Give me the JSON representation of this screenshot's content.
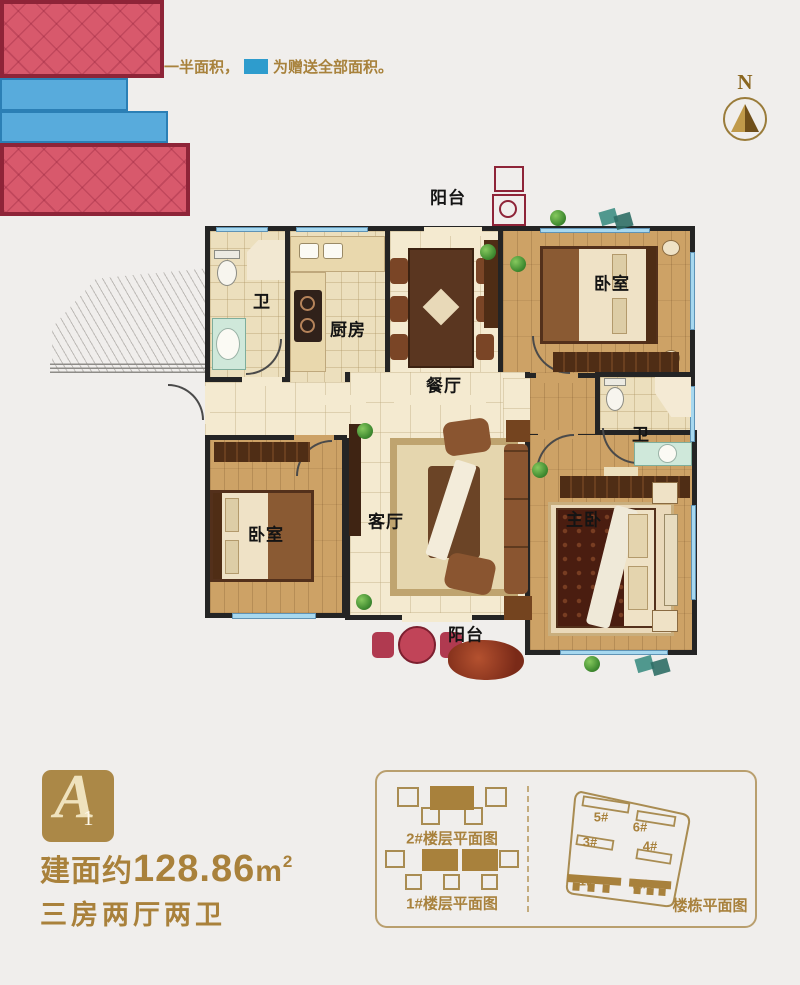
{
  "legend": {
    "prefix": "备注：",
    "half_area_label": "为赠送一半面积，",
    "full_area_label": "为赠送全部面积。",
    "half_area_color": "#cb1b23",
    "full_area_color": "#2e9ccd"
  },
  "compass": {
    "north_label": "N"
  },
  "floorplan": {
    "rooms": {
      "balcony_top": "阳台",
      "bedroom_top_right": "卧室",
      "bathroom_left": "卫",
      "kitchen": "厨房",
      "dining": "餐厅",
      "living": "客厅",
      "bedroom_left": "卧室",
      "master_bedroom": "主卧",
      "bathroom_right": "卫",
      "balcony_bottom": "阳台"
    },
    "gift_half_color": "#d8596c",
    "gift_full_color": "#58abdc"
  },
  "summary": {
    "badge_letter": "A",
    "badge_digit": "1",
    "area_prefix": "建面约",
    "area_value": "128.86",
    "area_unit": "m",
    "area_superscript": "2",
    "layout_text": "三房两厅两卫"
  },
  "panel": {
    "floor2_label": "2#楼层平面图",
    "floor1_label": "1#楼层平面图",
    "site_label": "楼栋平面图",
    "buildings": [
      "5#",
      "6#",
      "3#",
      "4#",
      "1#",
      "2#"
    ]
  }
}
